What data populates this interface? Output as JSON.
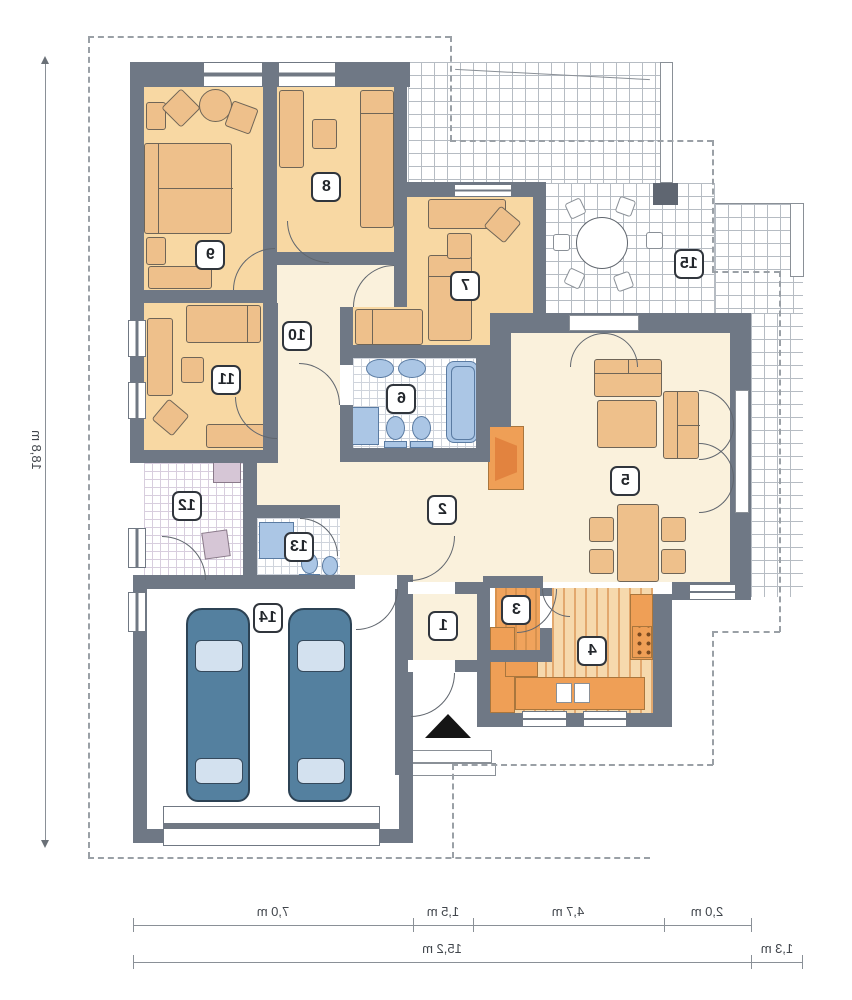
{
  "rooms": [
    {
      "label": "1"
    },
    {
      "label": "2"
    },
    {
      "label": "3"
    },
    {
      "label": "4"
    },
    {
      "label": "5"
    },
    {
      "label": "6"
    },
    {
      "label": "7"
    },
    {
      "label": "8"
    },
    {
      "label": "9"
    },
    {
      "label": "10"
    },
    {
      "label": "11"
    },
    {
      "label": "12"
    },
    {
      "label": "13"
    },
    {
      "label": "14"
    },
    {
      "label": "15"
    }
  ],
  "dimensions": {
    "vertical_total": "18,8 m",
    "bottom_segments": [
      "7,0 m",
      "1,5 m",
      "4,7 m",
      "2,0 m"
    ],
    "bottom_total": "15,2 m",
    "bottom_right": "1,3 m"
  },
  "colors": {
    "wall": "#6f7885",
    "bedroom_floor": "#f8d8a3",
    "hall_floor": "#faf1dc",
    "kitchen_accent": "#ef9f56",
    "fixture_blue": "#abc6e5",
    "car_body": "#54809f",
    "terrace_grid": "#b6bcc3"
  },
  "icons": {
    "entrance_arrow": "up-triangle"
  }
}
